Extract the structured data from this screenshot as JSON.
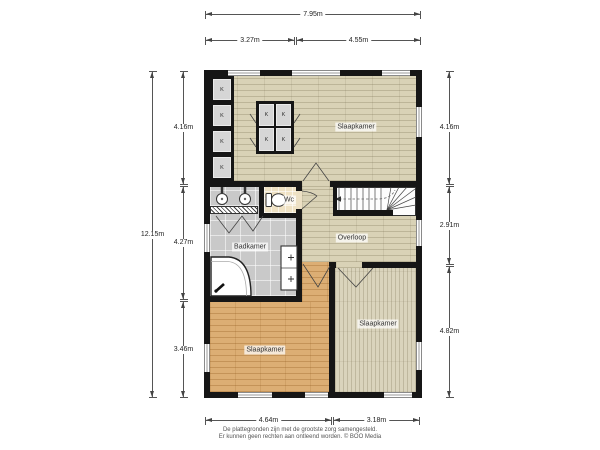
{
  "plan": {
    "rooms": {
      "bedroom_top": "Slaapkamer",
      "bedroom_bottom_left": "Slaapkamer",
      "bedroom_bottom_right": "Slaapkamer",
      "bathroom": "Badkamer",
      "toilet": "Wc",
      "landing": "Overloop"
    },
    "closet_label": "K"
  },
  "dimensions": {
    "top_total": "7.95m",
    "top_left": "3.27m",
    "top_right": "4.55m",
    "left_total": "12.15m",
    "left_top": "4.16m",
    "left_middle": "4.27m",
    "left_bottom": "3.46m",
    "right_top": "4.16m",
    "right_middle": "2.91m",
    "right_bottom": "4.82m",
    "bottom_left": "4.64m",
    "bottom_right": "3.18m"
  },
  "footer": {
    "line1": "De plattegronden zijn met de grootste zorg samengesteld.",
    "line2": "Er kunnen geen rechten aan ontleend worden. © BOO Media"
  },
  "colors": {
    "wall": "#161616",
    "floor_wood_light": "#d9d2b6",
    "floor_wood_orange": "#dcae74",
    "floor_wood_pale": "#dad4bc",
    "floor_tile_gray": "#c9c9c9",
    "floor_wc": "#efe2c4",
    "closet_gray": "#d6d6d6"
  }
}
